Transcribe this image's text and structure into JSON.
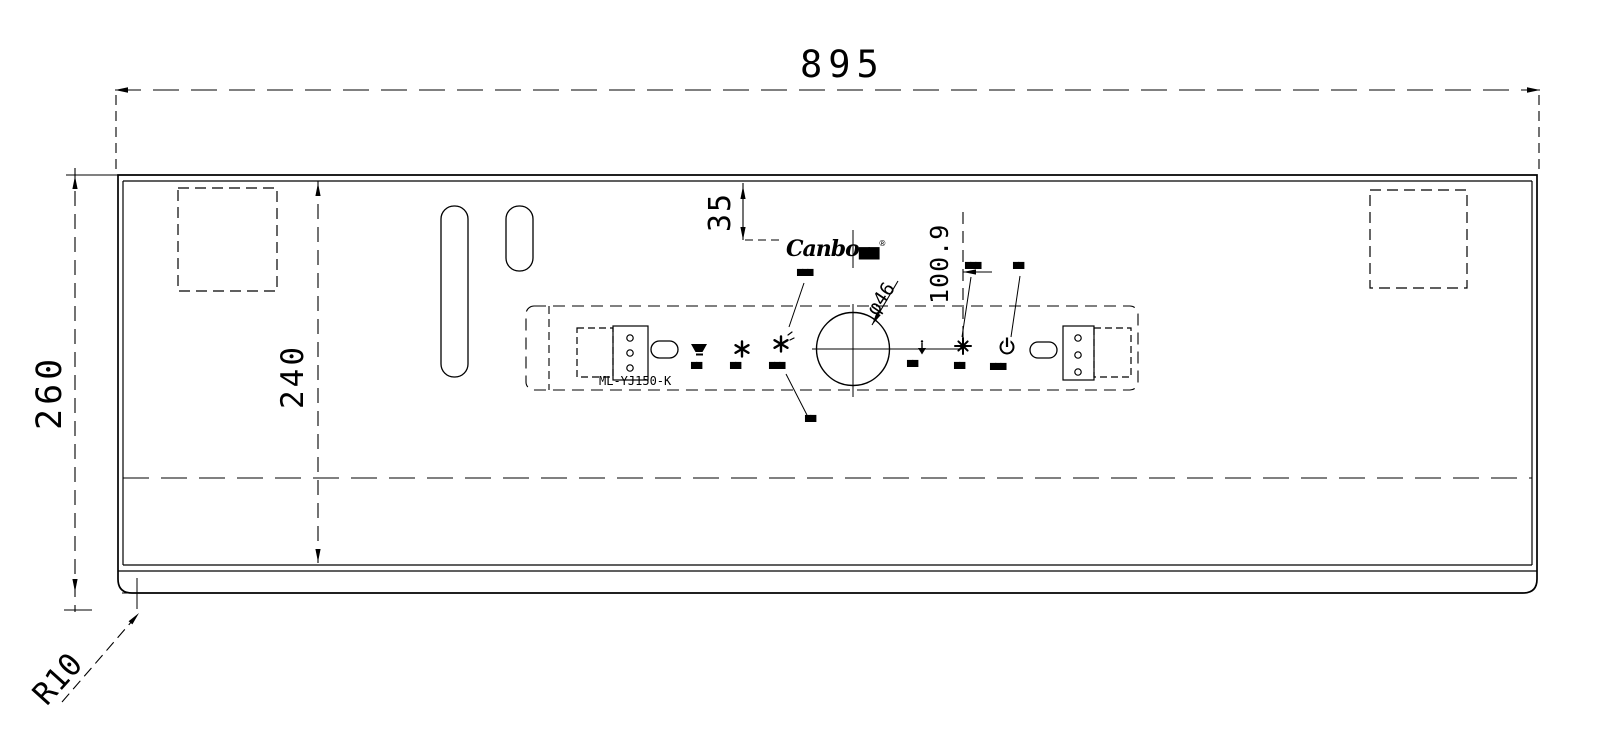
{
  "drawing": {
    "dim_width": "895",
    "dim_height": "260",
    "dim_inner": "240",
    "dim_logo_offset": "35",
    "dim_panel_offset": "100.9",
    "dim_hole": "φ46",
    "dim_corner": "R10"
  },
  "logo": {
    "brand": "Canbo",
    "cjk": "▆▆",
    "reg": "®"
  },
  "panel": {
    "model": "ML-YJ150-K",
    "button_labels": [
      "▆▆",
      "▆▆",
      "▆▆▆",
      "▆▆",
      "▆▆",
      "▆▆▆"
    ],
    "callouts": {
      "upper_left": "▆▆▆",
      "lower": "▆▆",
      "upper_fan": "▆▆▆",
      "upper_power": "▆▆"
    }
  },
  "colors": {
    "line": "#000000",
    "background": "#ffffff"
  }
}
